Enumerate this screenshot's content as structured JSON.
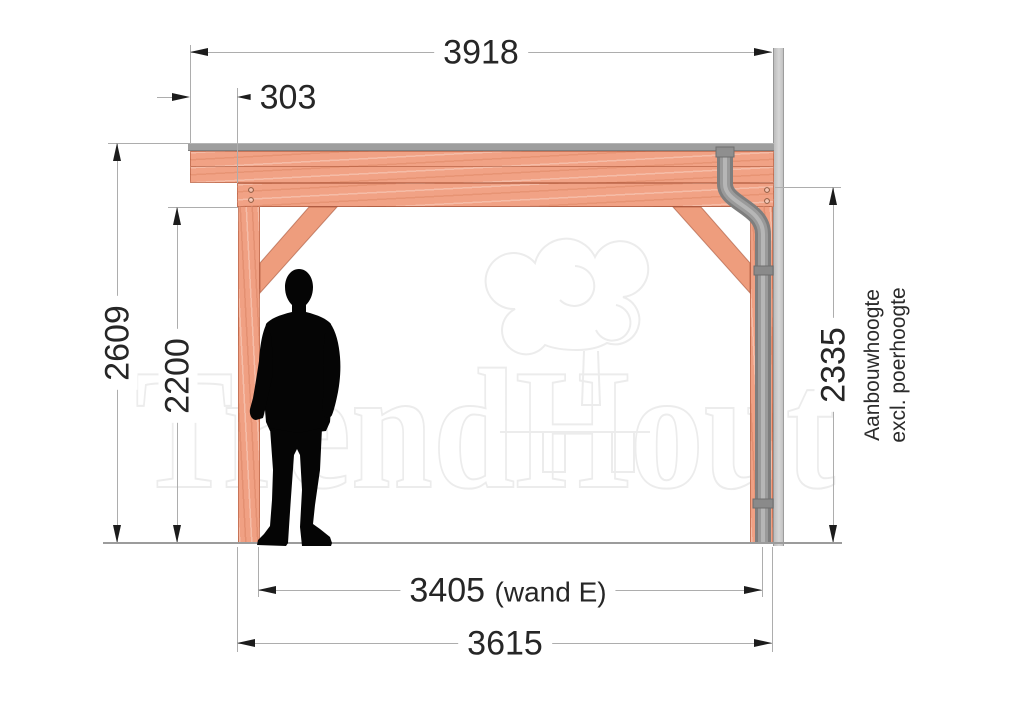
{
  "drawing": {
    "type": "side-elevation-veranda",
    "watermark": {
      "brand": "TrendHout",
      "logo": "tree-logo"
    },
    "figure": "standing-man-silhouette"
  },
  "colors": {
    "wood": "#f1a285",
    "roof": "#9e9e9e",
    "wall": "#cccccc",
    "pipe": "#8f8f8f",
    "dim_line": "#adadad",
    "dim_text": "#262626",
    "background": "#ffffff"
  },
  "dimensions": {
    "roof_width": "3918",
    "overhang": "303",
    "height_total": "2609",
    "height_clear": "2200",
    "height_attach": "2335",
    "height_attach_note_line1": "Aanbouwhoogte",
    "height_attach_note_line2": "excl. poerhoogte",
    "width_inner_value": "3405",
    "width_inner_suffix": "(wand E)",
    "width_outer": "3615"
  }
}
